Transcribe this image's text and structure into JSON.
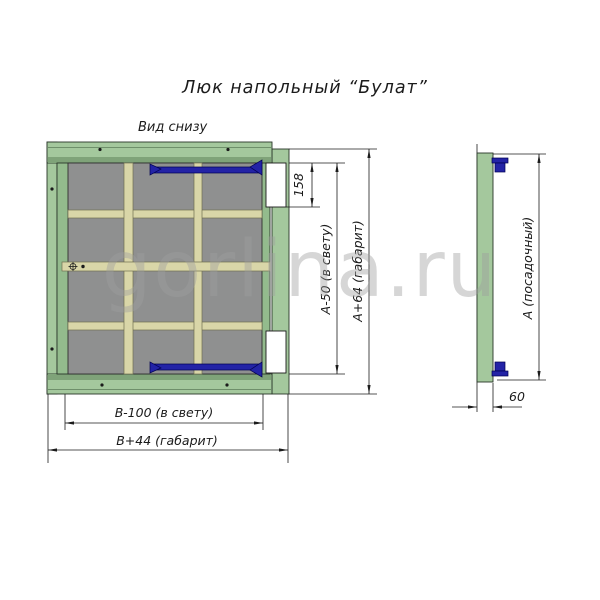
{
  "title": "Люк напольный “Булат”",
  "view": {
    "label": "Вид снизу"
  },
  "dims": {
    "notch_height": "158",
    "clear_height": "A-50 (в свету)",
    "overall_height": "A+64 (габарит)",
    "clear_width": "B-100 (в свету)",
    "overall_width": "B+44 (габарит)",
    "seating_height": "A (посадочный)",
    "profile_depth": "60"
  },
  "watermark": "gorlina.ru",
  "colors": {
    "frame_green": "#a4c89d",
    "frame_green_dark": "#7fa379",
    "door_edge_green": "#93bb8d",
    "panel_gray": "#8f9090",
    "stiffener_khaki": "#d9d6a8",
    "hinge_navy": "#2323a6",
    "watermark_gray": "#9f9f9f"
  }
}
